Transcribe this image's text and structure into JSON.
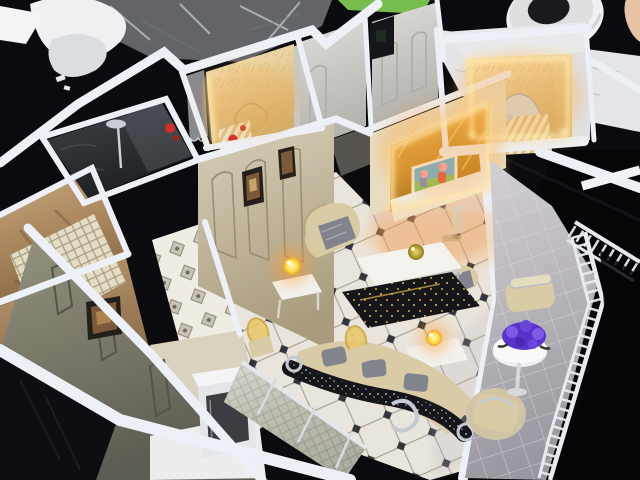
{
  "meta": {
    "kind": "photograph",
    "subject": "Miniature luxury apartment scale model (dollhouse) viewed from a high oblique angle on a dark workshop table",
    "width_px": 640,
    "height_px": 480
  },
  "scene": {
    "lighting": [
      "warm LED strip around carved headboard panel in top-right bedroom",
      "warm LED strip on carved panel in upper-left bedroom",
      "backlit gold mirrored TV feature wall",
      "two glowing miniature gold ball table lamps",
      "dim ambient workshop light"
    ],
    "objects": [
      {
        "name": "apartment-model",
        "label": "miniature apartment model with bright white wall tops"
      },
      {
        "name": "living-room-floor",
        "label": "diamond lattice marble tile floor with dark inset diamonds"
      },
      {
        "name": "tv-feature-wall",
        "label": "gold mirror TV wall with LED frame"
      },
      {
        "name": "tv-screen",
        "label": "TV playing cartoon with two pig characters on blue sky and green grass"
      },
      {
        "name": "bedroom-top-right",
        "label": "bedroom niche, carved cream panel, silver crown bed, striped duvet"
      },
      {
        "name": "bedroom-upper-left",
        "label": "bedroom with vertical LED strip, lace curtain, small bed with red pillow"
      },
      {
        "name": "bathroom",
        "label": "dark marble bathroom with chrome shower column"
      },
      {
        "name": "picture-wall",
        "label": "cream panelled wall with two framed paintings"
      },
      {
        "name": "curved-sofa",
        "label": "curved cream sofa with black rhinestone-studded back"
      },
      {
        "name": "armchair",
        "label": "baroque cream armchair with grey marble cushion"
      },
      {
        "name": "coffee-table-white",
        "label": "white rectangular coffee table with gold ball ornament"
      },
      {
        "name": "coffee-table-black",
        "label": "glossy black table with gold glitter"
      },
      {
        "name": "table-lamp",
        "label": "lit gold ball lamp on white side table"
      },
      {
        "name": "dining-chairs",
        "label": "chairs with translucent gold oval backs"
      },
      {
        "name": "sliding-mirror-doors",
        "label": "silver lattice mirrored sliding doors"
      },
      {
        "name": "kitchen-cabinet",
        "label": "white cabinet box with dark front panel"
      },
      {
        "name": "unfinished-rooms",
        "label": "kraft-tan unfinished rooms at left"
      },
      {
        "name": "olive-panel-wall",
        "label": "olive-grey panelled wall with small framed picture"
      },
      {
        "name": "balcony",
        "label": "balcony with pale tiles, white railing, cream seats"
      },
      {
        "name": "flower-bouquet",
        "label": "purple bouquet on round white pedestal table"
      },
      {
        "name": "plastic-wrap",
        "label": "crinkled plastic wrap on table"
      },
      {
        "name": "foam-curl",
        "label": "curled white foam sheet"
      },
      {
        "name": "paper-sheet",
        "label": "white paper sheet"
      },
      {
        "name": "masking-tape-roll",
        "label": "white masking tape roll"
      },
      {
        "name": "green-pad",
        "label": "green pad at top edge"
      },
      {
        "name": "fingertip",
        "label": "fingertip entering frame at top right"
      }
    ]
  },
  "palette": {
    "bg": "#0b0b0f",
    "bg_deep": "#060608",
    "glossy_black": "#0d0d12",
    "wall_top": "#edf0f6",
    "wall_face": "#d8d6d1",
    "wall_face_dark": "#b4b2ac",
    "cream_wall": "#cfc5ab",
    "kraft": "#c09a6e",
    "kraft_dark": "#8a6a46",
    "olive": "#8b897b",
    "olive_dark": "#64635a",
    "marble": "#33363b",
    "tile_base": "#e8e3da",
    "warm_tile": "#e2a381",
    "lavender_tint": "#b9b3c2",
    "led_warm": "#ffd27a",
    "led_deep": "#ff9d2e",
    "panel_lit": "#f3e3b4",
    "gold": "#d9a13c",
    "tv_sky": "#5cb5e4",
    "tv_grass": "#7fc45e",
    "peppa_pink": "#f2a6ba",
    "peppa_red": "#d95348",
    "peppa_blue": "#7187c9",
    "sofa_cream": "#d8cba5",
    "cushion_marble": "#81838d",
    "rhinestone": "#15151a",
    "silver": "#c6cad2",
    "balcony_floor": "#c8c5c9",
    "flower_purple": "#5a33cc",
    "flower_light": "#8059e8",
    "lamp_glow": "#ffe14e",
    "plastic_wrap": "#b9bec6",
    "paper": "#e4e5e8",
    "tape": "#f0f0f2",
    "tape_hole": "#1a1a1e",
    "green_pad": "#82cf55",
    "skin": "#e7c3a6",
    "console_white": "#efeee9",
    "fridge_panel": "#3c3d42",
    "duvet": "#efe3c4",
    "frame_dark": "#241f18",
    "art_brown": "#7a5a3a",
    "red_prop": "#d22d2a",
    "gold_ball": "#cdbd3e"
  }
}
